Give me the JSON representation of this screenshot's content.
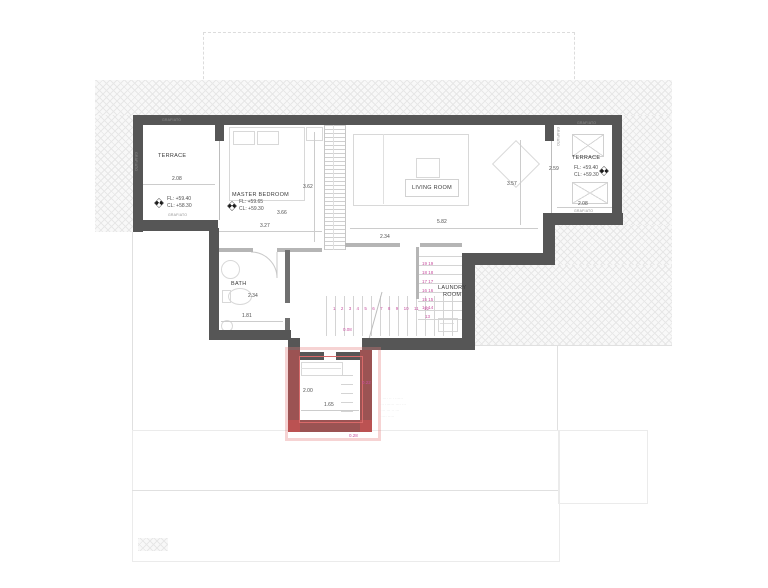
{
  "title": "upper floor plan",
  "colors": {
    "wall": "#565656",
    "highlight_red": "#d96a6a",
    "stair_magenta": "#c850a0"
  },
  "labels": {
    "terrace_left": {
      "name": "TERRACE",
      "dim": "2.08",
      "fl": "FL: +59.40",
      "cl": "CL: +58.30",
      "grafiato_top": "GRAFIATO",
      "grafiato_bottom": "GRAFIATO",
      "grafiato_side": "GRAFIATO"
    },
    "master_bedroom": {
      "name": "MASTER BEDROOM",
      "fl": "FL: +59.65",
      "cl": "CL: +59.30",
      "dim_right": "3.62",
      "dim_mid": "3.66",
      "dim_low": "3.27"
    },
    "living_room": {
      "name": "LIVING ROOM",
      "dim_right": "3.57",
      "dim_bottom": "5.82",
      "dim_left": "2.34"
    },
    "terrace_right": {
      "name": "TERRACE",
      "dim_left": "2.59",
      "dim_bottom": "2.08",
      "fl": "FL: +59.40",
      "cl": "CL: +59.30",
      "grafiato_top": "GRAFIATO",
      "grafiato_bottom": "GRAFIATO",
      "grafiato_side": "GRAFIATO"
    },
    "bath": {
      "name": "BATH",
      "dim_a": "2.34",
      "dim_b": "1.81"
    },
    "laundry": {
      "line1": "LAUNDRY",
      "line2": "ROOM"
    },
    "entry": {
      "dim_v": "2.00",
      "dim_h": "1.65",
      "off_right": "0.22",
      "off_bottom": "0.28"
    }
  },
  "stairs": {
    "run": [
      "1",
      "2",
      "3",
      "4",
      "5",
      "6",
      "7",
      "8",
      "9",
      "10",
      "11",
      "12"
    ],
    "upper": [
      "19 19",
      "18 18",
      "17 17",
      "16 16",
      "15 15",
      "14 14"
    ],
    "corner": "13",
    "offset": "0.08"
  },
  "note_lines": [
    "· ···· ·· · ······",
    "··· ······· ···· ···",
    "···· ··· ·· ···",
    "····· ·····"
  ]
}
